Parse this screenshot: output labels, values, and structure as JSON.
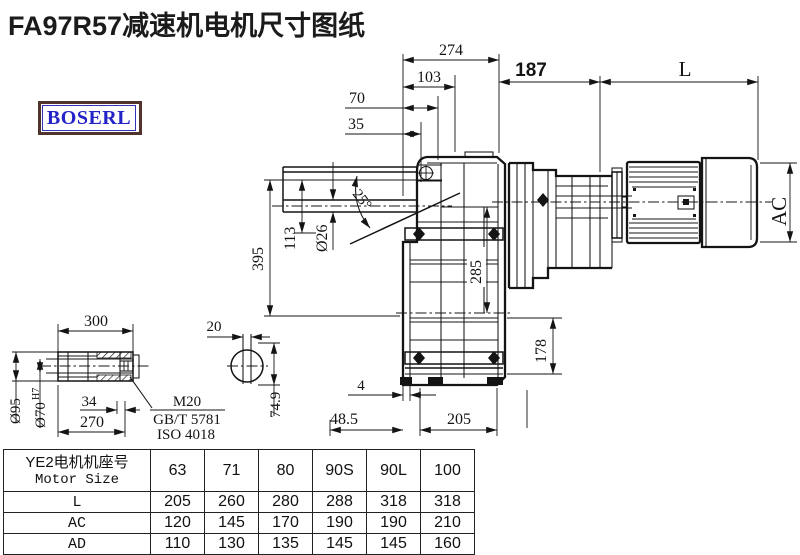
{
  "title": "FA97R57减速机电机尺寸图纸",
  "logo_text": "BOSERL",
  "colors": {
    "ink": "#141414",
    "title": "#1b1b1b",
    "logo_text": "#2323c8",
    "logo_border_outer": "#50342c",
    "logo_border_inner": "#3434bb"
  },
  "drawing": {
    "dims": {
      "d274": "274",
      "d103": "103",
      "d70": "70",
      "d35": "35",
      "d395": "395",
      "d113": "113",
      "d26": "Ø26",
      "angle": "25°",
      "d285": "285",
      "d187": "187",
      "L": "L",
      "AC": "AC",
      "d178": "178",
      "d4": "4",
      "d48_5": "48.5",
      "d205": "205"
    },
    "shaft_detail": {
      "d300": "300",
      "d95": "Ø95",
      "d70bore": "Ø70",
      "d70tol": "H7",
      "d34": "34",
      "d270": "270",
      "thread": "M20",
      "standard1": "GB/T 5781",
      "standard2": "ISO 4018",
      "d20": "20",
      "d74_9": "74.9"
    }
  },
  "table": {
    "motor_frame_label_cn": "YE2电机机座号",
    "motor_frame_label_en": "Motor Size",
    "frame_sizes": [
      "63",
      "71",
      "80",
      "90S",
      "90L",
      "100"
    ],
    "rows": [
      {
        "label": "L",
        "values": [
          "205",
          "260",
          "280",
          "288",
          "318",
          "318"
        ]
      },
      {
        "label": "AC",
        "values": [
          "120",
          "145",
          "170",
          "190",
          "190",
          "210"
        ]
      },
      {
        "label": "AD",
        "values": [
          "110",
          "130",
          "135",
          "145",
          "145",
          "160"
        ]
      }
    ]
  }
}
